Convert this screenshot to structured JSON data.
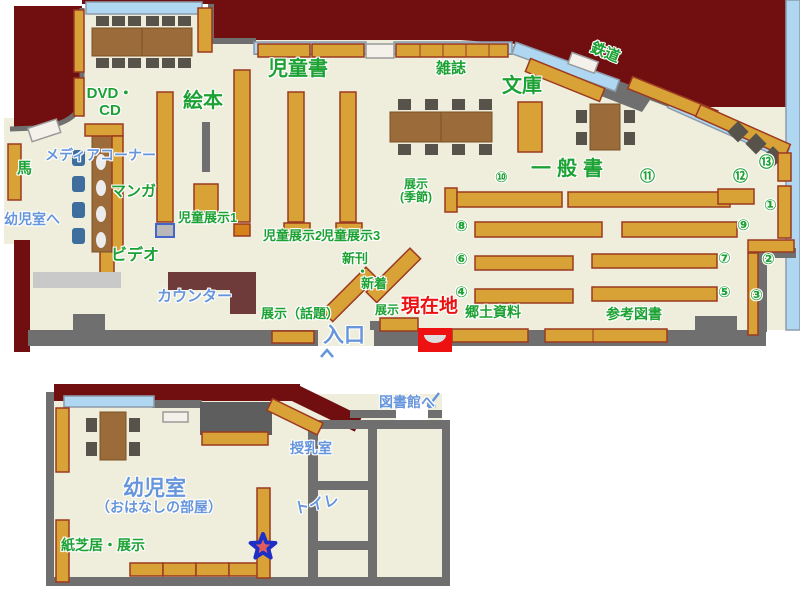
{
  "map_title": "library floor map",
  "colors": {
    "maroon": "#700E10",
    "floor": "#EFEEDC",
    "wall": "#6F6F6F",
    "light_gray": "#C9C9C9",
    "shelf": "#D9A237",
    "shelf_border": "#9B3A20",
    "shelf_cap": "#D4821A",
    "table": "#9C6B3A",
    "chair": "#57534A",
    "window": "#AFD7F2",
    "media_chair": "#3E6E9E",
    "counter": "#6F3A3A",
    "label_green": "#1CA133",
    "label_blue": "#6795DB",
    "label_red": "#EE1111",
    "marker_red": "#EE1111",
    "star_fill": "#F59393",
    "star_border": "#1F2FC5"
  },
  "icons": {
    "current_location_marker": "red-box-with-seat",
    "star_marker": "star",
    "to_library_arrow": "arrow-down-left",
    "entrance_arrow": "arrow-up"
  },
  "labels": [
    {
      "id": "jidosho",
      "text": "児童書",
      "x": 268,
      "y": 58,
      "c": "g",
      "s": 20
    },
    {
      "id": "zasshi",
      "text": "雑誌",
      "x": 436,
      "y": 61,
      "c": "g",
      "s": 15
    },
    {
      "id": "bunko",
      "text": "文庫",
      "x": 502,
      "y": 75,
      "c": "g",
      "s": 20
    },
    {
      "id": "tetsudo",
      "text": "鉄道",
      "x": 594,
      "y": 40,
      "c": "g",
      "s": 15,
      "rot": 22
    },
    {
      "id": "dvd-cd",
      "text": "DVD・\nCD",
      "x": 84,
      "y": 86,
      "c": "g",
      "s": 15,
      "w": 52
    },
    {
      "id": "ehon",
      "text": "絵本",
      "x": 183,
      "y": 90,
      "c": "g",
      "s": 20
    },
    {
      "id": "uma",
      "text": "馬",
      "x": 17,
      "y": 161,
      "c": "g",
      "s": 15
    },
    {
      "id": "manga",
      "text": "マンガ",
      "x": 111,
      "y": 184,
      "c": "g",
      "s": 15
    },
    {
      "id": "video",
      "text": "ビデオ",
      "x": 111,
      "y": 247,
      "c": "g",
      "s": 16
    },
    {
      "id": "jido-tenji-1",
      "text": "児童展示1",
      "x": 178,
      "y": 211,
      "c": "g",
      "s": 13
    },
    {
      "id": "jido-tenji-2",
      "text": "児童展示2",
      "x": 263,
      "y": 229,
      "c": "g",
      "s": 13
    },
    {
      "id": "jido-tenji-3",
      "text": "児童展示3",
      "x": 321,
      "y": 229,
      "c": "g",
      "s": 13
    },
    {
      "id": "shinkan",
      "text": "新刊",
      "x": 342,
      "y": 252,
      "c": "g",
      "s": 13
    },
    {
      "id": "nakaguro",
      "text": "・",
      "x": 356,
      "y": 265,
      "c": "g",
      "s": 13
    },
    {
      "id": "shinchaku",
      "text": "新着",
      "x": 361,
      "y": 277,
      "c": "g",
      "s": 13
    },
    {
      "id": "tenji-kisetsu",
      "text": "展示\n(季節)",
      "x": 392,
      "y": 178,
      "c": "g",
      "s": 12,
      "w": 48
    },
    {
      "id": "tenji-wadai",
      "text": "展示（話題）",
      "x": 261,
      "y": 307,
      "c": "g",
      "s": 13
    },
    {
      "id": "tenji-iriguchi",
      "text": "展示",
      "x": 375,
      "y": 304,
      "c": "g",
      "s": 12
    },
    {
      "id": "kyodo-shiryo",
      "text": "郷土資料",
      "x": 465,
      "y": 305,
      "c": "g",
      "s": 14
    },
    {
      "id": "sanko-tosho",
      "text": "参考図書",
      "x": 606,
      "y": 307,
      "c": "g",
      "s": 14
    },
    {
      "id": "ippansho",
      "text": "一般書",
      "x": 531,
      "y": 158,
      "c": "g",
      "s": 20,
      "ls": 6
    },
    {
      "id": "kamishibai-tenji",
      "text": "紙芝居・展示",
      "x": 61,
      "y": 538,
      "c": "g",
      "s": 14
    },
    {
      "id": "num-10",
      "text": "⑩",
      "x": 495,
      "y": 170,
      "c": "g",
      "s": 15
    },
    {
      "id": "num-11",
      "text": "⑪",
      "x": 640,
      "y": 169,
      "c": "g",
      "s": 15
    },
    {
      "id": "num-12",
      "text": "⑫",
      "x": 733,
      "y": 169,
      "c": "g",
      "s": 15
    },
    {
      "id": "num-13",
      "text": "⑬",
      "x": 759,
      "y": 155,
      "c": "g",
      "s": 15
    },
    {
      "id": "num-1",
      "text": "①",
      "x": 764,
      "y": 198,
      "c": "g",
      "s": 15
    },
    {
      "id": "num-2",
      "text": "②",
      "x": 762,
      "y": 252,
      "c": "g",
      "s": 15
    },
    {
      "id": "num-3",
      "text": "③",
      "x": 750,
      "y": 288,
      "c": "g",
      "s": 15
    },
    {
      "id": "num-9",
      "text": "⑨",
      "x": 737,
      "y": 218,
      "c": "g",
      "s": 15
    },
    {
      "id": "num-8",
      "text": "⑧",
      "x": 455,
      "y": 219,
      "c": "g",
      "s": 15
    },
    {
      "id": "num-7",
      "text": "⑦",
      "x": 718,
      "y": 251,
      "c": "g",
      "s": 15
    },
    {
      "id": "num-6",
      "text": "⑥",
      "x": 455,
      "y": 252,
      "c": "g",
      "s": 15
    },
    {
      "id": "num-5",
      "text": "⑤",
      "x": 718,
      "y": 285,
      "c": "g",
      "s": 15
    },
    {
      "id": "num-4",
      "text": "④",
      "x": 455,
      "y": 285,
      "c": "g",
      "s": 15
    },
    {
      "id": "media-corner",
      "text": "メディアコーナー",
      "x": 45,
      "y": 148,
      "c": "b",
      "s": 14
    },
    {
      "id": "yojishitsu-e",
      "text": "幼児室へ",
      "x": 4,
      "y": 212,
      "c": "b",
      "s": 14
    },
    {
      "id": "counter",
      "text": "カウンター",
      "x": 157,
      "y": 289,
      "c": "b",
      "s": 15
    },
    {
      "id": "iriguchi",
      "text": "入口",
      "x": 323,
      "y": 324,
      "c": "b",
      "s": 21
    },
    {
      "id": "toshokan-e",
      "text": "図書館へ",
      "x": 379,
      "y": 395,
      "c": "b",
      "s": 14
    },
    {
      "id": "yojishitsu",
      "text": "幼児室",
      "x": 123,
      "y": 477,
      "c": "b",
      "s": 21
    },
    {
      "id": "ohanashi-no-heya",
      "text": "（おはなしの部屋）",
      "x": 96,
      "y": 500,
      "c": "b",
      "s": 14
    },
    {
      "id": "junyushitsu",
      "text": "授乳室",
      "x": 290,
      "y": 441,
      "c": "b",
      "s": 14
    },
    {
      "id": "toire",
      "text": "トイレ",
      "x": 293,
      "y": 502,
      "c": "b",
      "s": 15,
      "rot": -12
    },
    {
      "id": "genzaichi",
      "text": "現在地",
      "x": 401,
      "y": 296,
      "c": "r",
      "s": 19
    }
  ]
}
